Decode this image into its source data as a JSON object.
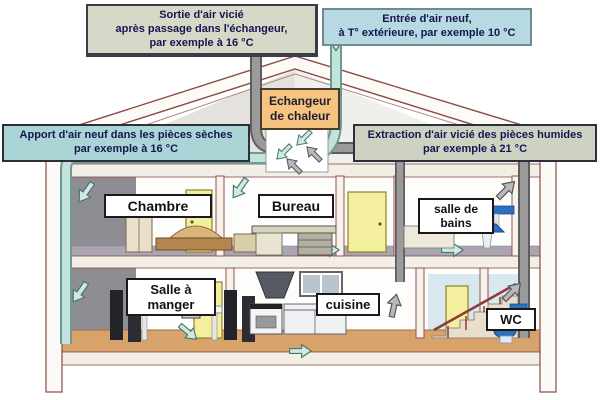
{
  "labels": {
    "exhaust_out": "Sortie d'air vicié\naprès passage dans l'échangeur,\npar exemple à 16 °C",
    "fresh_in": "Entrée d'air neuf,\nà T° extérieure, par exemple 10 °C",
    "supply": "Apport d'air neuf dans les pièces sèches\npar exemple à 16 °C",
    "extraction": "Extraction d'air vicié des pièces humides\npar exemple à 21 °C",
    "exchanger": "Echangeur\nde chaleur"
  },
  "rooms": {
    "chambre": "Chambre",
    "bureau": "Bureau",
    "salle_de_bains": "salle de\nbains",
    "salle_a_manger": "Salle à\nmanger",
    "cuisine": "cuisine",
    "wc": "WC"
  },
  "colors": {
    "fresh_air_duct": "#c2e2dc",
    "stale_air_duct": "#9a9a9a",
    "exchanger_box_bg": "#f6c480",
    "exhaust_label_bg": "#d6d9c8",
    "fresh_label_bg": "#b6d9e2",
    "supply_label_bg": "#aad4d6",
    "extraction_label_bg": "#ced2c2",
    "roof_outline": "#8e4a42",
    "door": "#f3ef9e",
    "ground_floor": "#d7a36b",
    "sanitary_blue": "#2d6fc0"
  }
}
